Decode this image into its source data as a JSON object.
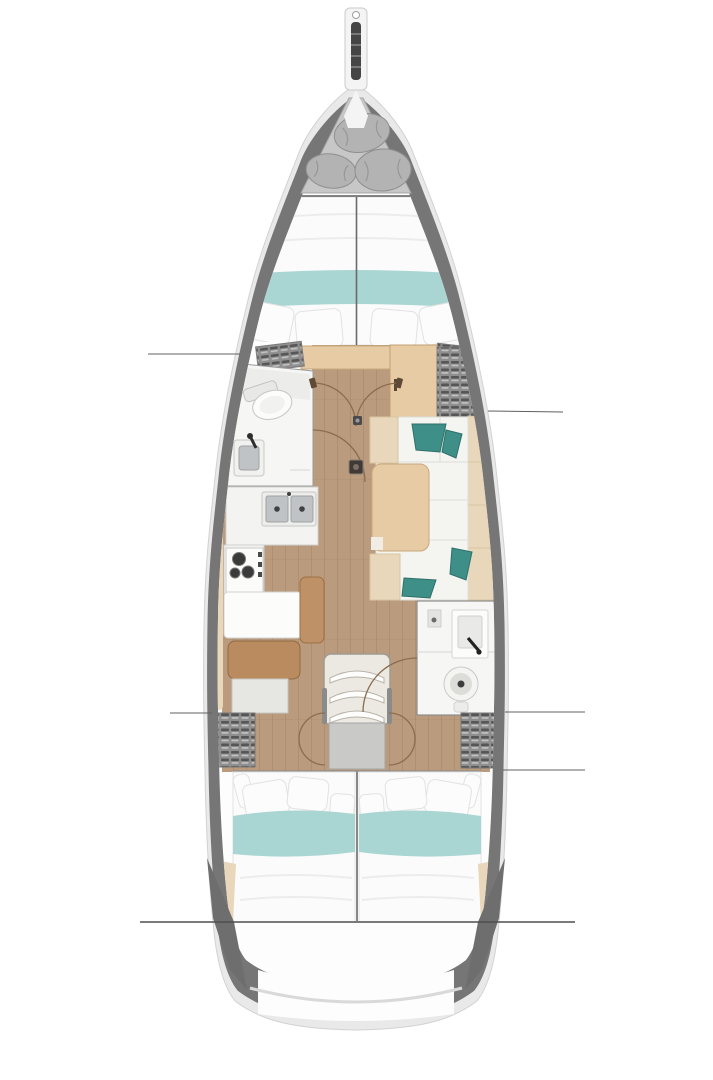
{
  "meta": {
    "title": "Sailboat interior floor plan (top-down deck layout)",
    "orientation": "bow-at-top",
    "visible_text": ""
  },
  "colors": {
    "page_bg": "#ffffff",
    "hull_rim": "#e9e9e9",
    "hull_wall": "#767676",
    "hull_inner": "#fdfdfd",
    "wood_floor": "#bb9b7d",
    "wood_light": "#e6cba4",
    "wood_bench": "#ba8b5e",
    "wood_panel": "#bf9166",
    "teal_band": "#a9d5d2",
    "teal_pillow": "#3e8f88",
    "beige_trim": "#e9d7bc",
    "locker_gray": "#8f8f8f",
    "locker_dark": "#6e6e6e",
    "landing_gray": "#c9c9c7",
    "bed_white": "#fbfbfb",
    "sofa_white": "#f4f4f0",
    "fixture_white": "#f6f6f5",
    "steel": "#c0c3c5",
    "anchor_gray": "#c7c7c7",
    "fender_gray": "#b3b3b3"
  },
  "sections": [
    {
      "id": "bowsprit",
      "label": "bowsprit with anchor roller"
    },
    {
      "id": "anchor-locker",
      "label": "anchor locker with stowed fenders"
    },
    {
      "id": "forward-cabin",
      "label": "forward cabin V-berth with teal runner"
    },
    {
      "id": "forward-head",
      "label": "forward head: toilet and sink"
    },
    {
      "id": "galley",
      "label": "galley: double sink, 3-burner stove, counters"
    },
    {
      "id": "nav-station",
      "label": "nav desk with bench seat"
    },
    {
      "id": "saloon",
      "label": "saloon: L-sofa, teal cushions, table"
    },
    {
      "id": "aft-head",
      "label": "aft head: sink and toilet"
    },
    {
      "id": "companionway",
      "label": "companionway steps and landing"
    },
    {
      "id": "aft-cabin-port",
      "label": "port aft cabin double berth"
    },
    {
      "id": "aft-cabin-starboard",
      "label": "starboard aft cabin double berth"
    },
    {
      "id": "stern",
      "label": "stern / transom"
    }
  ]
}
